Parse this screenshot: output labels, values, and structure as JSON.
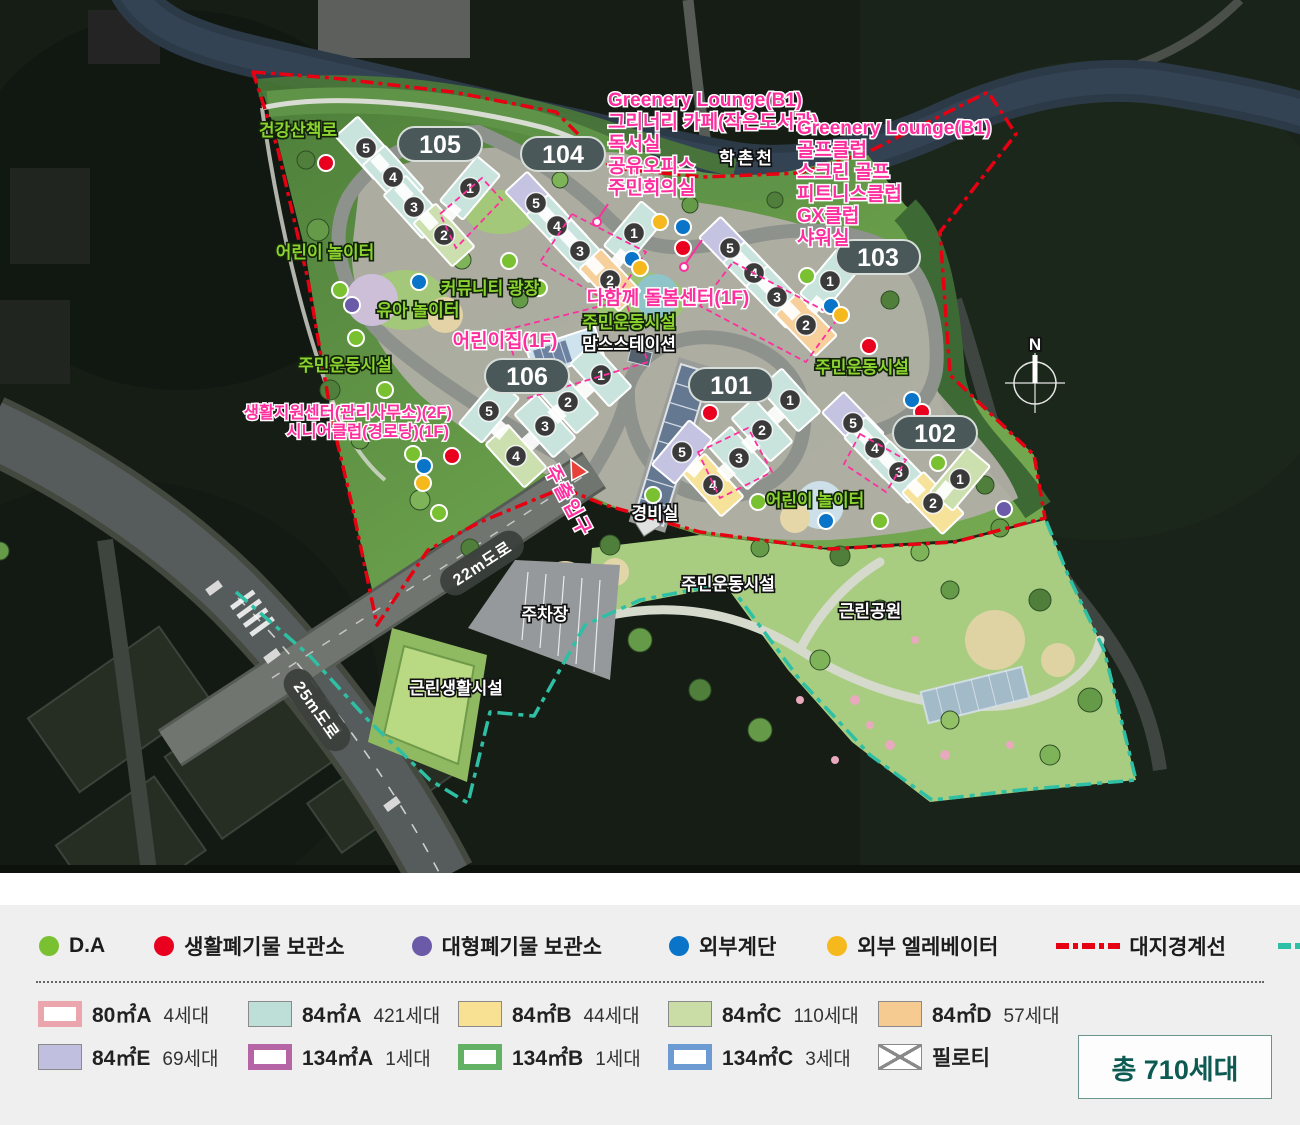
{
  "map": {
    "north_label": "N",
    "stream_label": "학촌천",
    "unit_numbers": [
      "1",
      "2",
      "3",
      "4",
      "5"
    ],
    "badges": [
      {
        "label": "105"
      },
      {
        "label": "104"
      },
      {
        "label": "103"
      },
      {
        "label": "106"
      },
      {
        "label": "101"
      },
      {
        "label": "102"
      }
    ],
    "annotations": {
      "lounge_west": {
        "lines": [
          "Greenery Lounge(B1)",
          "그리너리 카페(작은도서관)",
          "독서실",
          "공유오피스",
          "주민회의실"
        ]
      },
      "lounge_east": {
        "lines": [
          "Greenery Lounge(B1)",
          "골프클럽",
          "스크린 골프",
          "피트니스클럽",
          "GX클럽",
          "샤워실"
        ]
      },
      "care_center": "다함께 돌봄센터(1F)",
      "daycare": "어린이집(1F)",
      "support_center": "생활지원센터(관리사무소)(2F)",
      "senior_club": "시니어클럽(경로당)(1F)",
      "main_gate": "주출입구"
    },
    "places": {
      "health_trail": "건강산책로",
      "kids_playground_west": "어린이 놀이터",
      "community_plaza": "커뮤니티 광장",
      "toddler_playground": "유아 놀이터",
      "sports_west": "주민운동시설",
      "sports_center": "주민운동시설",
      "moms_station": "맘스스테이션",
      "sports_103": "주민운동시설",
      "guard_post": "경비실",
      "kids_playground_east": "어린이 놀이터",
      "parking": "주차장",
      "road_22m": "22m도로",
      "road_25m": "25m도로",
      "neighborhood_facility": "근린생활시설",
      "sports_park": "주민운동시설",
      "park": "근린공원"
    },
    "colors": {
      "badge_bg": "#4a585a",
      "label_green": "#8bd42f",
      "label_pink": "#ff2e9e",
      "site_boundary": "#e60012",
      "district_boundary": "#2fbfa4"
    }
  },
  "legend": {
    "facilities": [
      {
        "label": "D.A",
        "color": "#7ac131"
      },
      {
        "label": "생활폐기물 보관소",
        "color": "#e8001e"
      },
      {
        "label": "대형폐기물 보관소",
        "color": "#6a5aa8"
      },
      {
        "label": "외부계단",
        "color": "#0a74c8"
      },
      {
        "label": "외부 엘레베이터",
        "color": "#f5b91e"
      }
    ],
    "boundaries": [
      {
        "label": "대지경계선",
        "color": "#e60012"
      },
      {
        "label": "구역경계선",
        "color": "#2fbfa4"
      }
    ],
    "unit_types": [
      {
        "label": "80㎡A",
        "count": "4세대",
        "color": "#eba6ad"
      },
      {
        "label": "84㎡A",
        "count": "421세대",
        "color": "#bedfd8"
      },
      {
        "label": "84㎡B",
        "count": "44세대",
        "color": "#f8e193"
      },
      {
        "label": "84㎡C",
        "count": "110세대",
        "color": "#cadda6"
      },
      {
        "label": "84㎡D",
        "count": "57세대",
        "color": "#f6cb92"
      },
      {
        "label": "84㎡E",
        "count": "69세대",
        "color": "#c0bfe0"
      },
      {
        "label": "134㎡A",
        "count": "1세대",
        "color": "#b565a5"
      },
      {
        "label": "134㎡B",
        "count": "1세대",
        "color": "#62b164"
      },
      {
        "label": "134㎡C",
        "count": "3세대",
        "color": "#6b9bd2"
      },
      {
        "label": "필로티",
        "count": "",
        "color": "#ffffff"
      }
    ],
    "total": "총 710세대"
  }
}
